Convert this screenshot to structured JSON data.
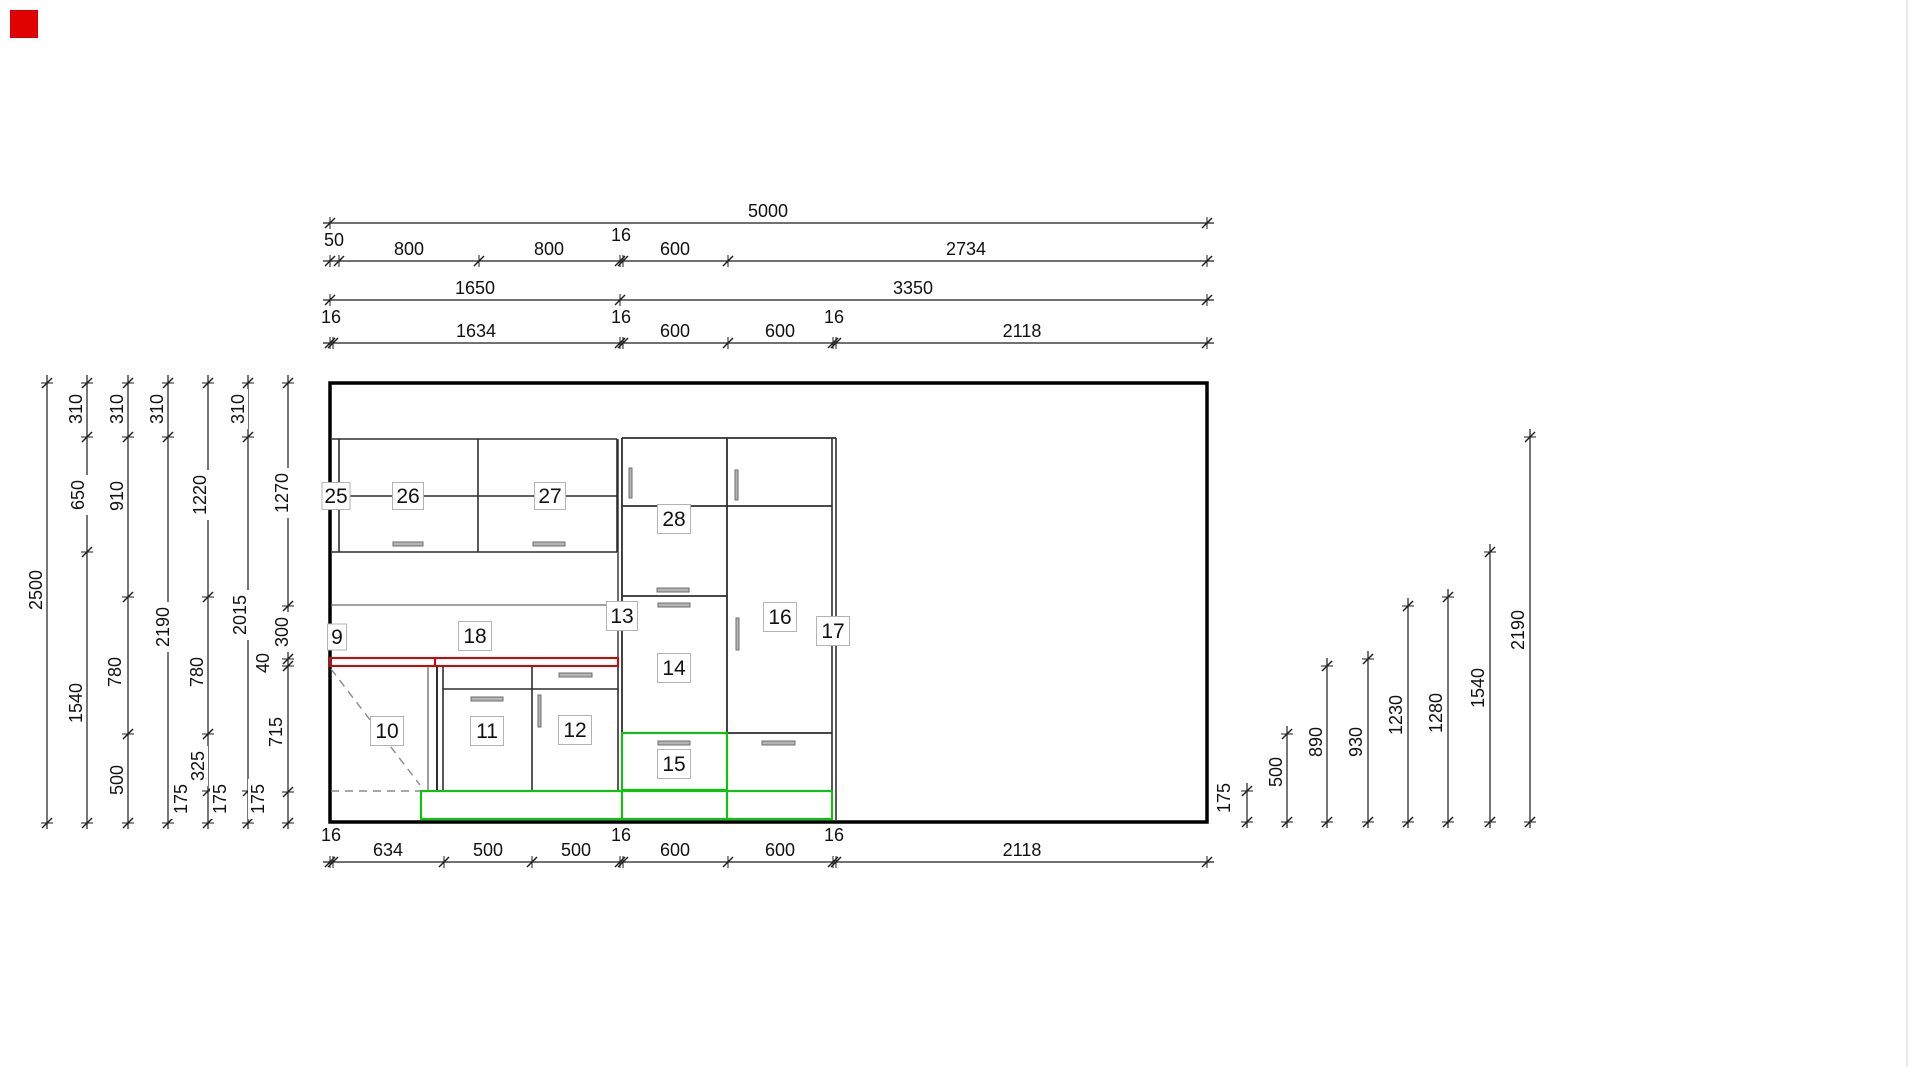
{
  "palette": {
    "wall": "#000000",
    "line": "#2e2e2e",
    "thin": "#6a6a6a",
    "dim": "#1c1c1c",
    "red": "#dd0000",
    "green": "#00cc00",
    "dash": "#8a8a8a",
    "handle_fill": "#b4b4b4",
    "handle_stroke": "#6e6e6e",
    "label_border": "#b3b3b3",
    "faint": "#e3e3e3",
    "marker": "#e00000"
  },
  "marker": {
    "x": 10,
    "y": 10,
    "size": 28
  },
  "window_edge": {
    "x": 1907,
    "y1": 0,
    "y2": 1067
  },
  "wall": {
    "x": 330,
    "y": 383,
    "w": 877,
    "h": 439
  },
  "h_dims": [
    {
      "name": "dim-top-overall",
      "y": 223,
      "ticks": [
        330,
        1207
      ],
      "labels": [
        {
          "t": "5000",
          "x": 768,
          "y": 217
        }
      ]
    },
    {
      "name": "dim-top-row2",
      "y": 261,
      "ticks": [
        330,
        339,
        479,
        620,
        623,
        728,
        1207
      ],
      "labels": [
        {
          "t": "50",
          "x": 334,
          "y": 246
        },
        {
          "t": "800",
          "x": 409,
          "y": 255
        },
        {
          "t": "800",
          "x": 549,
          "y": 255
        },
        {
          "t": "16",
          "x": 621,
          "y": 241
        },
        {
          "t": "600",
          "x": 675,
          "y": 255
        },
        {
          "t": "2734",
          "x": 966,
          "y": 255
        }
      ]
    },
    {
      "name": "dim-top-row3",
      "y": 300,
      "ticks": [
        330,
        620,
        1207
      ],
      "labels": [
        {
          "t": "1650",
          "x": 475,
          "y": 294
        },
        {
          "t": "3350",
          "x": 913,
          "y": 294
        }
      ]
    },
    {
      "name": "dim-top-row4",
      "y": 343,
      "ticks": [
        330,
        333,
        620,
        623,
        728,
        833,
        836,
        1207
      ],
      "labels": [
        {
          "t": "16",
          "x": 331,
          "y": 323
        },
        {
          "t": "1634",
          "x": 476,
          "y": 337
        },
        {
          "t": "16",
          "x": 621,
          "y": 323
        },
        {
          "t": "600",
          "x": 675,
          "y": 337
        },
        {
          "t": "600",
          "x": 780,
          "y": 337
        },
        {
          "t": "16",
          "x": 834,
          "y": 323
        },
        {
          "t": "2118",
          "x": 1022,
          "y": 337
        }
      ]
    },
    {
      "name": "dim-bottom",
      "y": 862,
      "ticks": [
        330,
        333,
        444,
        532,
        620,
        623,
        728,
        833,
        836,
        1207
      ],
      "labels": [
        {
          "t": "16",
          "x": 331,
          "y": 841
        },
        {
          "t": "634",
          "x": 388,
          "y": 856
        },
        {
          "t": "500",
          "x": 488,
          "y": 856
        },
        {
          "t": "500",
          "x": 576,
          "y": 856
        },
        {
          "t": "16",
          "x": 621,
          "y": 841
        },
        {
          "t": "600",
          "x": 675,
          "y": 856
        },
        {
          "t": "600",
          "x": 780,
          "y": 856
        },
        {
          "t": "16",
          "x": 834,
          "y": 841
        },
        {
          "t": "2118",
          "x": 1022,
          "y": 856
        }
      ]
    }
  ],
  "v_dims": [
    {
      "name": "dim-left-1",
      "x": 47,
      "ticks": [
        383,
        823
      ],
      "labels": [
        {
          "t": "2500",
          "x": 36,
          "y": 590
        }
      ]
    },
    {
      "name": "dim-left-2",
      "x": 87,
      "ticks": [
        383,
        437,
        552,
        823
      ],
      "labels": [
        {
          "t": "310",
          "x": 76,
          "y": 409
        },
        {
          "t": "650",
          "x": 78,
          "y": 495
        },
        {
          "t": "1540",
          "x": 76,
          "y": 703
        }
      ]
    },
    {
      "name": "dim-left-3",
      "x": 128,
      "ticks": [
        383,
        437,
        597,
        734,
        823
      ],
      "labels": [
        {
          "t": "310",
          "x": 117,
          "y": 409
        },
        {
          "t": "910",
          "x": 117,
          "y": 496
        },
        {
          "t": "780",
          "x": 115,
          "y": 672
        },
        {
          "t": "500",
          "x": 117,
          "y": 780
        }
      ]
    },
    {
      "name": "dim-left-4",
      "x": 168,
      "ticks": [
        383,
        437,
        823
      ],
      "labels": [
        {
          "t": "310",
          "x": 157,
          "y": 409
        },
        {
          "t": "2190",
          "x": 163,
          "y": 627
        }
      ]
    },
    {
      "name": "dim-left-5",
      "x": 208,
      "ticks": [
        383,
        597,
        734,
        791,
        823
      ],
      "labels": [
        {
          "t": "1220",
          "x": 200,
          "y": 495
        },
        {
          "t": "780",
          "x": 197,
          "y": 672
        },
        {
          "t": "325",
          "x": 198,
          "y": 766
        },
        {
          "t": "175",
          "x": 181,
          "y": 799
        }
      ]
    },
    {
      "name": "dim-left-6",
      "x": 248,
      "ticks": [
        383,
        437,
        791,
        823
      ],
      "labels": [
        {
          "t": "310",
          "x": 238,
          "y": 409
        },
        {
          "t": "2015",
          "x": 240,
          "y": 615
        },
        {
          "t": "175",
          "x": 220,
          "y": 799
        }
      ]
    },
    {
      "name": "dim-left-7",
      "x": 288,
      "ticks": [
        383,
        606,
        659,
        666,
        792,
        823
      ],
      "labels": [
        {
          "t": "1270",
          "x": 282,
          "y": 493
        },
        {
          "t": "300",
          "x": 282,
          "y": 632
        },
        {
          "t": "40",
          "x": 263,
          "y": 663
        },
        {
          "t": "715",
          "x": 276,
          "y": 732
        },
        {
          "t": "175",
          "x": 258,
          "y": 799
        }
      ]
    },
    {
      "name": "dim-right-175",
      "x": 1247,
      "ticks": [
        791,
        822
      ],
      "labels": [
        {
          "t": "175",
          "x": 1224,
          "y": 798
        }
      ]
    },
    {
      "name": "dim-right-500",
      "x": 1287,
      "ticks": [
        734,
        822
      ],
      "labels": [
        {
          "t": "500",
          "x": 1276,
          "y": 772
        }
      ]
    },
    {
      "name": "dim-right-890",
      "x": 1327,
      "ticks": [
        666,
        822
      ],
      "labels": [
        {
          "t": "890",
          "x": 1316,
          "y": 742
        }
      ]
    },
    {
      "name": "dim-right-930",
      "x": 1368,
      "ticks": [
        659,
        822
      ],
      "labels": [
        {
          "t": "930",
          "x": 1356,
          "y": 742
        }
      ]
    },
    {
      "name": "dim-right-1230",
      "x": 1408,
      "ticks": [
        606,
        822
      ],
      "labels": [
        {
          "t": "1230",
          "x": 1396,
          "y": 715
        }
      ]
    },
    {
      "name": "dim-right-1280",
      "x": 1448,
      "ticks": [
        597,
        822
      ],
      "labels": [
        {
          "t": "1280",
          "x": 1436,
          "y": 713
        }
      ]
    },
    {
      "name": "dim-right-1540",
      "x": 1490,
      "ticks": [
        552,
        822
      ],
      "labels": [
        {
          "t": "1540",
          "x": 1478,
          "y": 688
        }
      ]
    },
    {
      "name": "dim-right-2190",
      "x": 1530,
      "ticks": [
        437,
        822
      ],
      "labels": [
        {
          "t": "2190",
          "x": 1518,
          "y": 630
        }
      ]
    }
  ],
  "lines": [
    {
      "x1": 332,
      "y1": 439,
      "x2": 617,
      "y2": 439,
      "c": "line",
      "w": 1.6
    },
    {
      "x1": 332,
      "y1": 496,
      "x2": 617,
      "y2": 496,
      "c": "line",
      "w": 1.4
    },
    {
      "x1": 332,
      "y1": 552,
      "x2": 617,
      "y2": 552,
      "c": "line",
      "w": 1.6
    },
    {
      "x1": 339,
      "y1": 439,
      "x2": 339,
      "y2": 552,
      "c": "line",
      "w": 1.6
    },
    {
      "x1": 478,
      "y1": 439,
      "x2": 478,
      "y2": 552,
      "c": "line",
      "w": 1.6
    },
    {
      "x1": 617,
      "y1": 439,
      "x2": 617,
      "y2": 552,
      "c": "line",
      "w": 1.6
    },
    {
      "x1": 331,
      "y1": 605,
      "x2": 618,
      "y2": 605,
      "c": "thin",
      "w": 1.2
    },
    {
      "x1": 618,
      "y1": 439,
      "x2": 618,
      "y2": 658,
      "c": "line",
      "w": 1.4
    },
    {
      "x1": 622,
      "y1": 438,
      "x2": 622,
      "y2": 733,
      "c": "line",
      "w": 1.8
    },
    {
      "x1": 727,
      "y1": 438,
      "x2": 727,
      "y2": 790,
      "c": "line",
      "w": 1.8
    },
    {
      "x1": 832,
      "y1": 438,
      "x2": 832,
      "y2": 820,
      "c": "line",
      "w": 1.6
    },
    {
      "x1": 836,
      "y1": 438,
      "x2": 836,
      "y2": 820,
      "c": "line",
      "w": 1.6
    },
    {
      "x1": 622,
      "y1": 438,
      "x2": 836,
      "y2": 438,
      "c": "line",
      "w": 1.8
    },
    {
      "x1": 622,
      "y1": 506,
      "x2": 832,
      "y2": 506,
      "c": "line",
      "w": 1.8
    },
    {
      "x1": 622,
      "y1": 596,
      "x2": 727,
      "y2": 596,
      "c": "line",
      "w": 1.8
    },
    {
      "x1": 622,
      "y1": 733,
      "x2": 832,
      "y2": 733,
      "c": "line",
      "w": 1.8
    },
    {
      "x1": 428,
      "y1": 667,
      "x2": 428,
      "y2": 791,
      "c": "thin",
      "w": 1.3
    },
    {
      "x1": 437,
      "y1": 667,
      "x2": 437,
      "y2": 791,
      "c": "line",
      "w": 2
    },
    {
      "x1": 443,
      "y1": 667,
      "x2": 443,
      "y2": 791,
      "c": "line",
      "w": 1.6
    },
    {
      "x1": 532,
      "y1": 667,
      "x2": 532,
      "y2": 791,
      "c": "line",
      "w": 1.6
    },
    {
      "x1": 618,
      "y1": 667,
      "x2": 618,
      "y2": 791,
      "c": "line",
      "w": 1.6
    },
    {
      "x1": 443,
      "y1": 689,
      "x2": 618,
      "y2": 689,
      "c": "line",
      "w": 1.6
    },
    {
      "x1": 331,
      "y1": 669,
      "x2": 420,
      "y2": 785,
      "c": "dash",
      "w": 1.4,
      "dash": "8,6"
    },
    {
      "x1": 331,
      "y1": 791,
      "x2": 420,
      "y2": 791,
      "c": "dash",
      "w": 1.4,
      "dash": "8,6"
    },
    {
      "x1": 622,
      "y1": 791,
      "x2": 622,
      "y2": 819,
      "c": "green",
      "w": 2
    },
    {
      "x1": 727,
      "y1": 791,
      "x2": 727,
      "y2": 819,
      "c": "green",
      "w": 2
    }
  ],
  "rects": [
    {
      "name": "countertop-left",
      "x": 330,
      "y": 658,
      "w": 105,
      "h": 8,
      "c": "red",
      "sw": 2
    },
    {
      "name": "countertop-right",
      "x": 435,
      "y": 658,
      "w": 183,
      "h": 8,
      "c": "red",
      "sw": 2
    },
    {
      "name": "plinth-highlight",
      "x": 421,
      "y": 791,
      "w": 411,
      "h": 28,
      "c": "green",
      "sw": 2
    },
    {
      "name": "front-15-highlight",
      "x": 622,
      "y": 733,
      "w": 105,
      "h": 57,
      "c": "green",
      "sw": 2
    }
  ],
  "handles": [
    {
      "x": 393,
      "y": 542,
      "w": 30,
      "h": 4
    },
    {
      "x": 533,
      "y": 542,
      "w": 32,
      "h": 4
    },
    {
      "x": 629,
      "y": 468,
      "w": 3,
      "h": 30
    },
    {
      "x": 735,
      "y": 470,
      "w": 3,
      "h": 30
    },
    {
      "x": 657,
      "y": 588,
      "w": 32,
      "h": 4
    },
    {
      "x": 658,
      "y": 603,
      "w": 32,
      "h": 4
    },
    {
      "x": 736,
      "y": 618,
      "w": 3,
      "h": 32
    },
    {
      "x": 658,
      "y": 741,
      "w": 32,
      "h": 4
    },
    {
      "x": 762,
      "y": 741,
      "w": 33,
      "h": 4
    },
    {
      "x": 471,
      "y": 697,
      "w": 32,
      "h": 4
    },
    {
      "x": 559,
      "y": 673,
      "w": 33,
      "h": 4
    },
    {
      "x": 538,
      "y": 695,
      "w": 3,
      "h": 32
    }
  ],
  "items": [
    {
      "num": "9",
      "x": 337,
      "y": 637,
      "w": 19,
      "h": 26
    },
    {
      "num": "10",
      "x": 387,
      "y": 731,
      "w": 33,
      "h": 29
    },
    {
      "num": "11",
      "x": 487,
      "y": 731,
      "w": 33,
      "h": 29
    },
    {
      "num": "12",
      "x": 575,
      "y": 730,
      "w": 33,
      "h": 29
    },
    {
      "num": "13",
      "x": 622,
      "y": 616,
      "w": 31,
      "h": 29
    },
    {
      "num": "14",
      "x": 674,
      "y": 668,
      "w": 33,
      "h": 29
    },
    {
      "num": "15",
      "x": 674,
      "y": 764,
      "w": 33,
      "h": 29
    },
    {
      "num": "16",
      "x": 780,
      "y": 617,
      "w": 33,
      "h": 29
    },
    {
      "num": "17",
      "x": 833,
      "y": 631,
      "w": 33,
      "h": 29
    },
    {
      "num": "18",
      "x": 475,
      "y": 636,
      "w": 33,
      "h": 29
    },
    {
      "num": "25",
      "x": 336,
      "y": 496,
      "w": 28,
      "h": 27
    },
    {
      "num": "26",
      "x": 408,
      "y": 496,
      "w": 31,
      "h": 27
    },
    {
      "num": "27",
      "x": 550,
      "y": 496,
      "w": 31,
      "h": 27
    },
    {
      "num": "28",
      "x": 674,
      "y": 519,
      "w": 33,
      "h": 29
    }
  ]
}
